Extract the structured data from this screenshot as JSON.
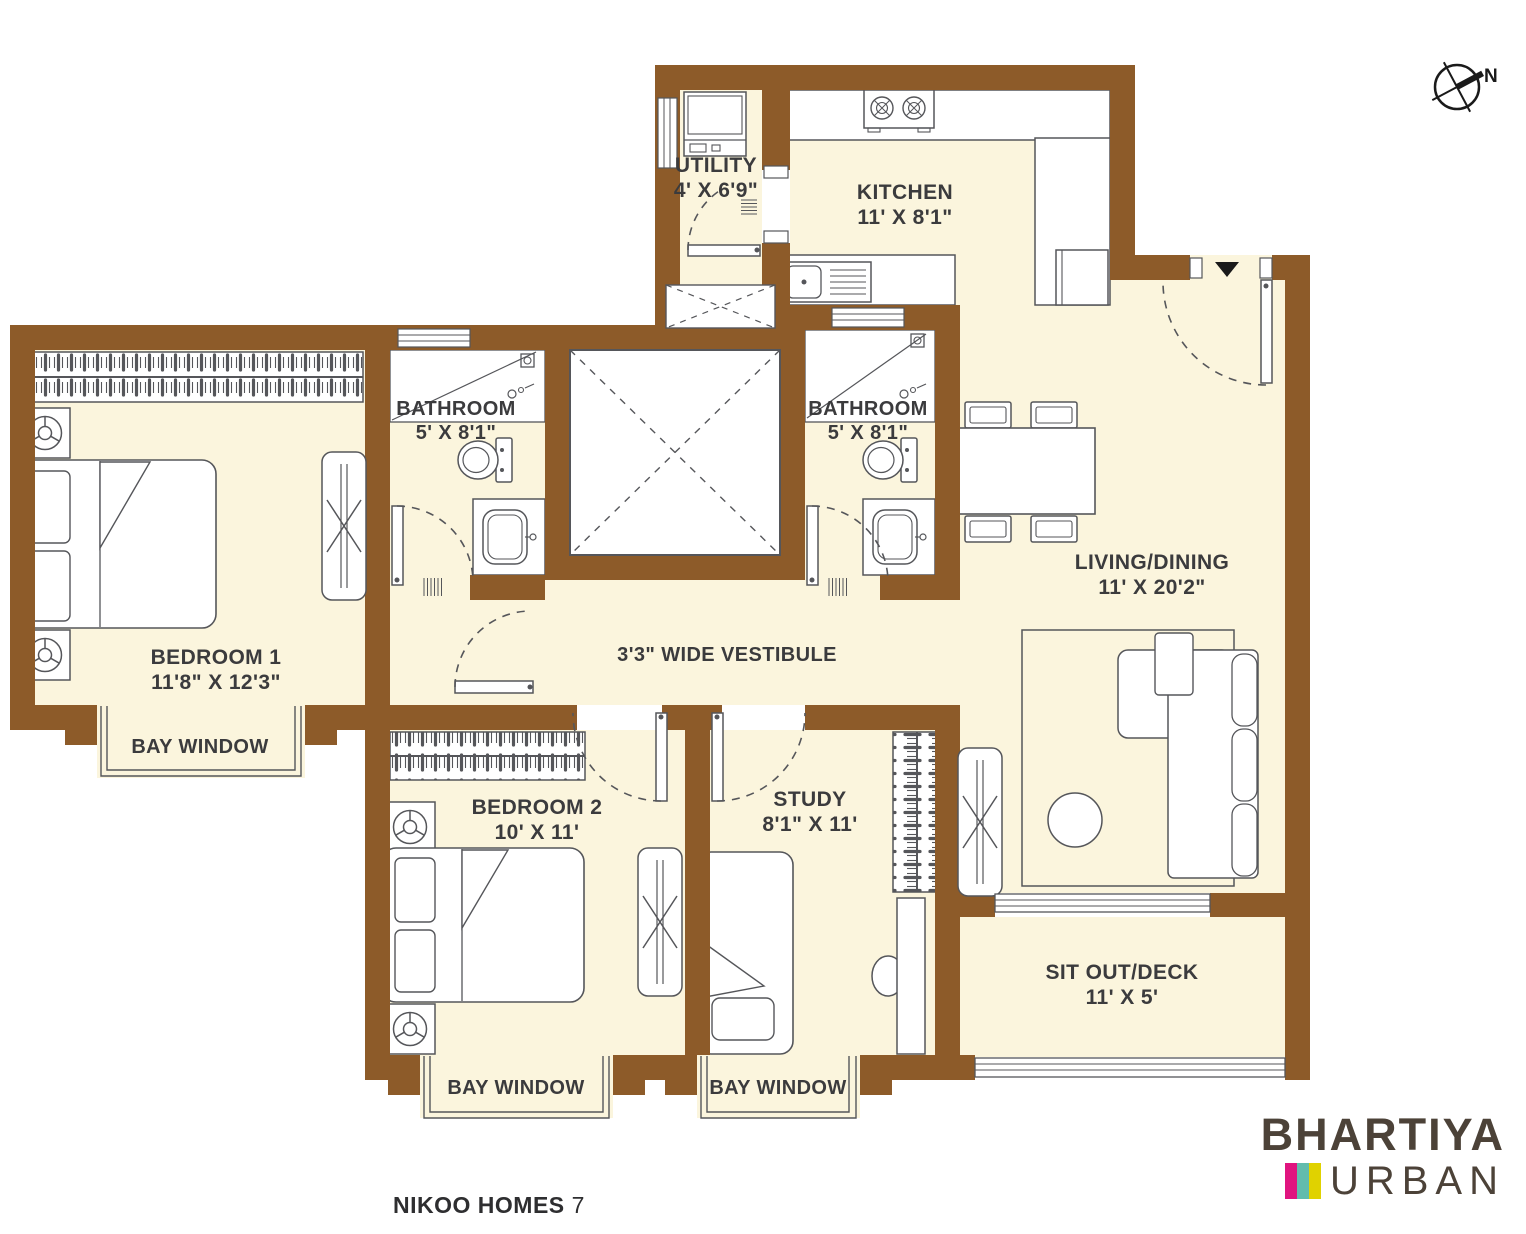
{
  "palette": {
    "wall": "#8D5B29",
    "floor": "#FBF5DD",
    "line": "#55565A",
    "label": "#3B3B3D",
    "brand_text": "#4C4238",
    "bar_pink": "#E0147F",
    "bar_teal": "#62BCAD",
    "bar_yellow": "#E0D200"
  },
  "compass": {
    "label": "N"
  },
  "rooms": {
    "utility": {
      "name": "UTILITY",
      "dims": "4' X 6'9\""
    },
    "kitchen": {
      "name": "KITCHEN",
      "dims": "11' X 8'1\""
    },
    "bathroom1": {
      "name": "BATHROOM",
      "dims": "5' X 8'1\""
    },
    "bathroom2": {
      "name": "BATHROOM",
      "dims": "5' X 8'1\""
    },
    "bedroom1": {
      "name": "BEDROOM 1",
      "dims": "11'8\" X 12'3\""
    },
    "bedroom2": {
      "name": "BEDROOM 2",
      "dims": "10' X 11'"
    },
    "study": {
      "name": "STUDY",
      "dims": "8'1\" X 11'"
    },
    "living_dining": {
      "name": "LIVING/DINING",
      "dims": "11' X 20'2\""
    },
    "vestibule": {
      "name": "3'3\" WIDE VESTIBULE"
    },
    "sit_out": {
      "name": "SIT OUT/DECK",
      "dims": "11' X 5'"
    },
    "bay_window": {
      "name": "BAY WINDOW"
    }
  },
  "footer": {
    "project": "NIKOO HOMES",
    "unit": "7"
  },
  "brand": {
    "name": "BHARTIYA",
    "division": "URBAN",
    "bars": [
      {
        "style": "background:#E0147F"
      },
      {
        "style": "background:#62BCAD"
      },
      {
        "style": "background:#E0D200"
      }
    ]
  }
}
